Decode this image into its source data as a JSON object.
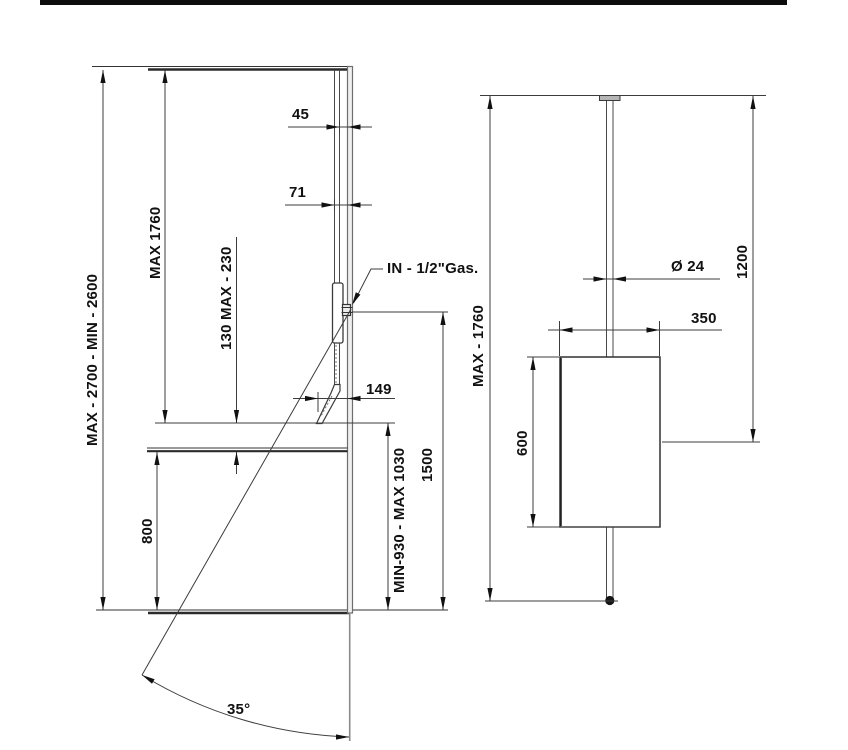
{
  "left_view": {
    "overall_height": "MAX - 2700 - MIN - 2600",
    "ceiling_to_spout": "MAX 1760",
    "spout_to_shelf": "130 MAX - 230",
    "pipe_wall_gap_rear": "45",
    "pipe_wall_gap_front": "71",
    "water_inlet": "IN - 1/2\"Gas.",
    "spout_projection": "149",
    "shelf_height": "800",
    "inlet_height": "1500",
    "spout_height": "MIN-930 - MAX 1030",
    "swivel_angle": "35°"
  },
  "right_view": {
    "pipe_diameter": "Ø 24",
    "pipe_length": "1200",
    "body_width": "350",
    "ceiling_to_handshower": "MAX - 1760",
    "body_height": "600"
  }
}
